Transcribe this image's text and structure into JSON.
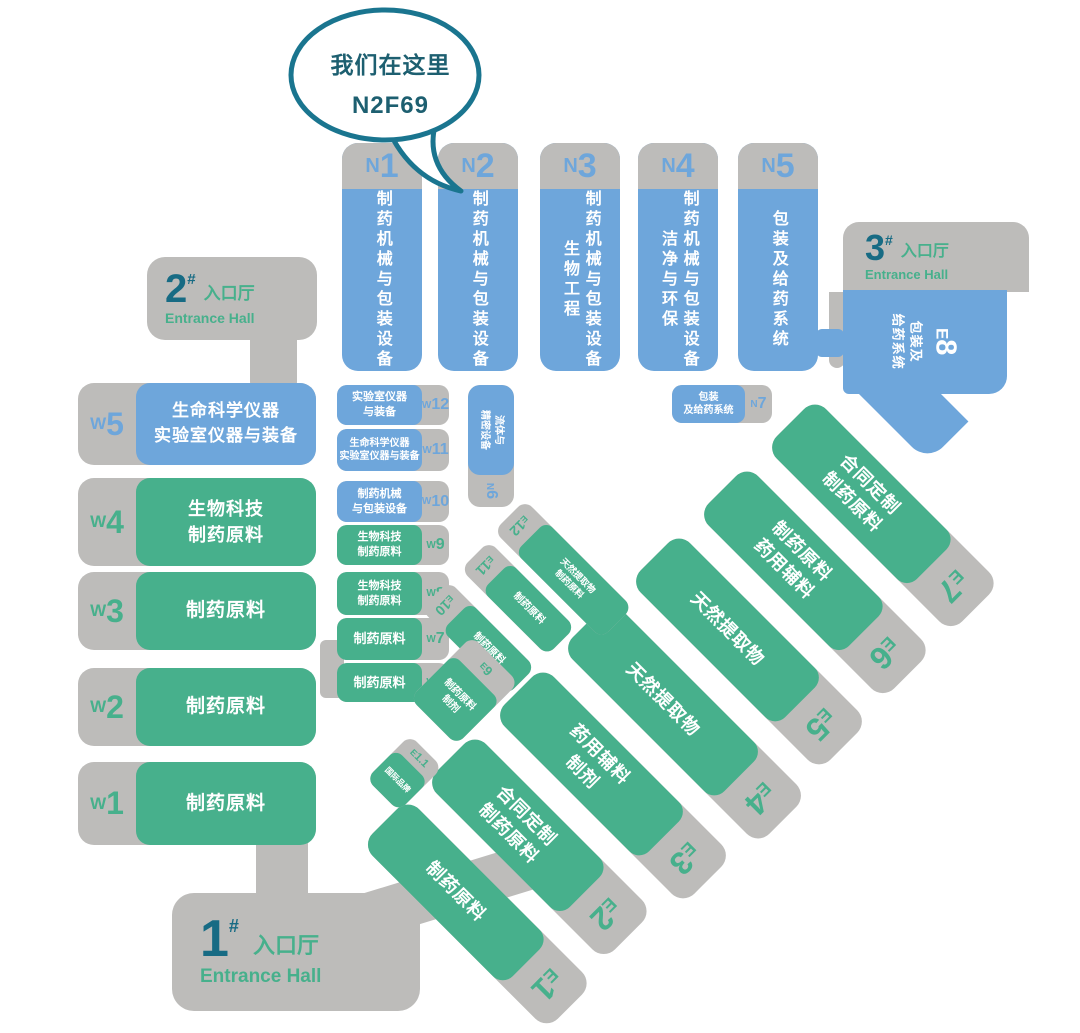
{
  "bubble": {
    "line1": "我们在这里",
    "line2": "N2F69"
  },
  "colors": {
    "blue": "#6ea6db",
    "green": "#47b08c",
    "gray": "#bdbcba",
    "teal": "#176b84"
  },
  "entrances": {
    "hall1": {
      "num": "1",
      "hash": "#",
      "cn": "入口厅",
      "en": "Entrance Hall"
    },
    "hall2": {
      "num": "2",
      "hash": "#",
      "cn": "入口厅",
      "en": "Entrance Hall"
    },
    "hall3": {
      "num": "3",
      "hash": "#",
      "cn": "入口厅",
      "en": "Entrance Hall"
    }
  },
  "north_halls": [
    {
      "prefix": "N",
      "num": "1",
      "line1": "制药机械与包装设备"
    },
    {
      "prefix": "N",
      "num": "2",
      "line1": "制药机械与包装设备"
    },
    {
      "prefix": "N",
      "num": "3",
      "line1": "制药机械与包装设备",
      "line2": "生物工程"
    },
    {
      "prefix": "N",
      "num": "4",
      "line1": "制药机械与包装设备",
      "line2": "洁净与环保"
    },
    {
      "prefix": "N",
      "num": "5",
      "line1": "包装及给药系统"
    }
  ],
  "n6": {
    "prefix": "N",
    "num": "6",
    "line1": "流体与",
    "line2": "精密设备"
  },
  "n7": {
    "prefix": "N",
    "num": "7",
    "line1": "包装",
    "line2": "及给药系统"
  },
  "e8": {
    "prefix": "E",
    "num": "8",
    "line1": "包装及",
    "line2": "给药系统"
  },
  "west_halls": [
    {
      "prefix": "W",
      "num": "5",
      "line1": "生命科学仪器",
      "line2": "实验室仪器与装备"
    },
    {
      "prefix": "W",
      "num": "4",
      "line1": "生物科技",
      "line2": "制药原料"
    },
    {
      "prefix": "W",
      "num": "3",
      "line1": "制药原料"
    },
    {
      "prefix": "W",
      "num": "2",
      "line1": "制药原料"
    },
    {
      "prefix": "W",
      "num": "1",
      "line1": "制药原料"
    }
  ],
  "west_small": [
    {
      "prefix": "W",
      "num": "12",
      "line1": "实验室仪器",
      "line2": "与装备"
    },
    {
      "prefix": "W",
      "num": "11",
      "line1": "生命科学仪器",
      "line2": "实验室仪器与装备"
    },
    {
      "prefix": "W",
      "num": "10",
      "line1": "制药机械",
      "line2": "与包装设备"
    },
    {
      "prefix": "W",
      "num": "9",
      "line1": "生物科技",
      "line2": "制药原料"
    },
    {
      "prefix": "W",
      "num": "8",
      "line1": "生物科技",
      "line2": "制药原料"
    },
    {
      "prefix": "W",
      "num": "7",
      "line1": "制药原料"
    },
    {
      "prefix": "W",
      "num": "6",
      "line1": "制药原料"
    }
  ],
  "east_halls": [
    {
      "prefix": "E",
      "num": "7",
      "line1": "合同定制",
      "line2": "制药原料"
    },
    {
      "prefix": "E",
      "num": "6",
      "line1": "制药原料",
      "line2": "药用辅料"
    },
    {
      "prefix": "E",
      "num": "5",
      "line1": "天然提取物"
    },
    {
      "prefix": "E",
      "num": "4",
      "line1": "天然提取物"
    },
    {
      "prefix": "E",
      "num": "3",
      "line1": "药用辅料",
      "line2": "制剂"
    },
    {
      "prefix": "E",
      "num": "2",
      "line1": "合同定制",
      "line2": "制药原料"
    },
    {
      "prefix": "E",
      "num": "1",
      "line1": "制药原料"
    }
  ],
  "east_small": [
    {
      "prefix": "E",
      "num": "12",
      "line1": "天然提取物",
      "line2": "制药原料"
    },
    {
      "prefix": "E",
      "num": "11",
      "line1": "制药原料"
    },
    {
      "prefix": "E",
      "num": "10",
      "line1": "制药原料"
    },
    {
      "prefix": "E",
      "num": "9",
      "line1": "制药原料",
      "line2": "制剂"
    },
    {
      "prefix": "E",
      "num": "1.1",
      "line1": "国际品牌"
    }
  ]
}
